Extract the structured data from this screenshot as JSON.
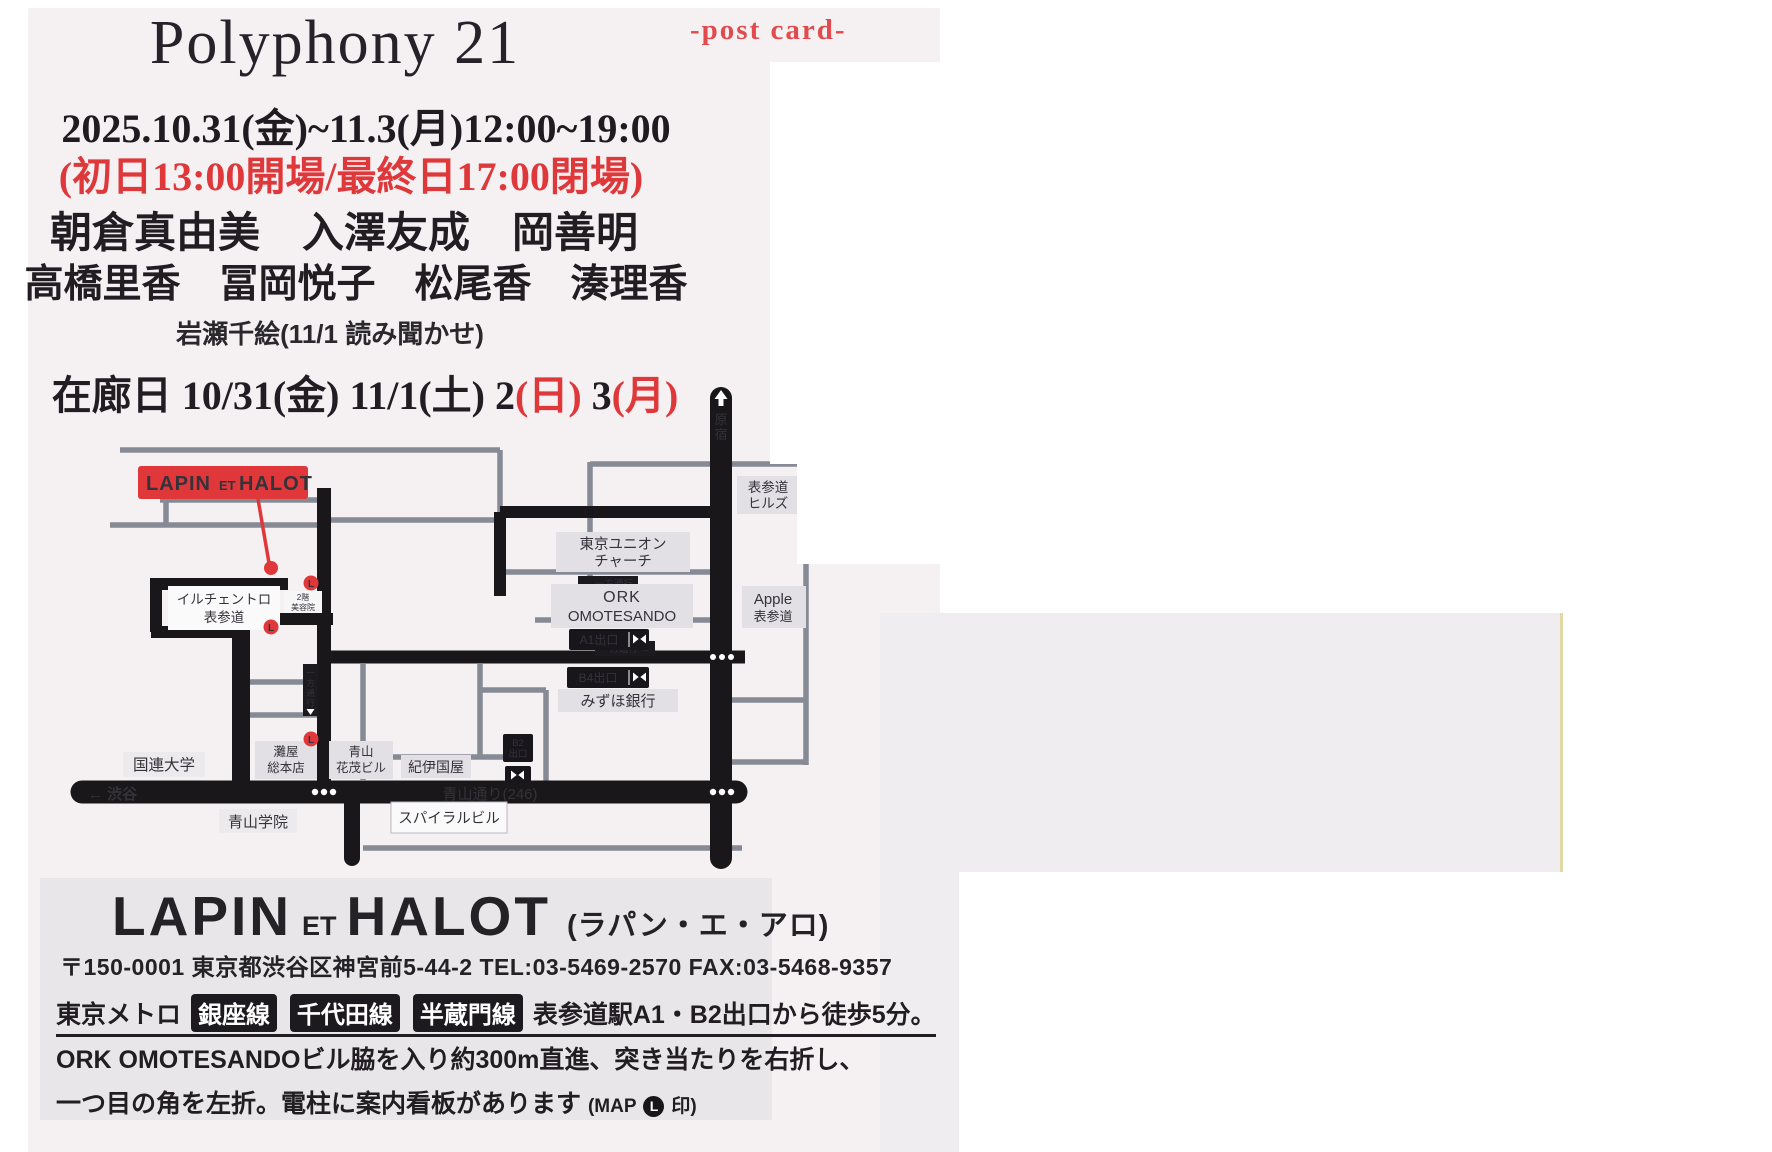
{
  "page": {
    "background": "#ffffff",
    "card_color": "#f5f1f2",
    "accent_red": "#e0393c",
    "ink": "#211d23"
  },
  "header": {
    "title": "Polyphony 21",
    "postcard_label": "-post card-",
    "date_line": "2025.10.31(金)~11.3(月)12:00~19:00",
    "notice_red": "(初日13:00開場/最終日17:00閉場)",
    "artists_line1": "朝倉真由美　入澤友成　岡善明",
    "artists_line2": "高橋里香　冨岡悦子　松尾香　湊理香",
    "reading_line": "岩瀬千絵(11/1 読み聞かせ)",
    "attendance": {
      "part1": "在廊日  10/31(金)  11/1(土)  2",
      "red1": "(日)",
      "part2": "  3",
      "red2": "(月)"
    }
  },
  "map": {
    "venue_badge_parts": [
      "LAPIN",
      "ET",
      "HALOT"
    ],
    "harajuku": [
      "原",
      "宿"
    ],
    "omotesando_hills": [
      "表参道",
      "ヒルズ"
    ],
    "tokyo_union_church": [
      "東京ユニオン",
      "チャーチ"
    ],
    "oneway_left": "← 一方通行",
    "oneway_right": "一方通行 →",
    "oneway_vertical": [
      "一",
      "方",
      "通",
      "行"
    ],
    "il_centro": [
      "イルチェントロ",
      "表参道"
    ],
    "salon_2f": [
      "2階",
      "美容院"
    ],
    "ork": [
      "ORK",
      "OMOTESANDO"
    ],
    "apple": [
      "Apple",
      "表参道"
    ],
    "exit_a1": "A1出口",
    "exit_b4": "B4出口",
    "exit_b2": [
      "B2",
      "出口"
    ],
    "mizuho": "みずほ銀行",
    "kinokuniya": "紀伊国屋",
    "kokuren": "国連大学",
    "nadaya": [
      "灘屋",
      "総本店"
    ],
    "hanashige": [
      "青山",
      "花茂ビル"
    ],
    "aoyama_gakuin": "青山学院",
    "spiral": "スパイラルビル",
    "shibuya": "← 渋谷",
    "aoyama_dori": "青山通り(246)",
    "l_mark": "L"
  },
  "info": {
    "name_lapin": "LAPIN",
    "name_et": "ET",
    "name_halot": "HALOT",
    "name_kana": "(ラパン・エ・アロ)",
    "address": "〒150-0001 東京都渋谷区神宮前5-44-2  TEL:03-5469-2570  FAX:03-5468-9357",
    "line1_prefix": "東京メトロ",
    "line_badges": [
      "銀座線",
      "千代田線",
      "半蔵門線"
    ],
    "line1_suffix": " 表参道駅A1・B2出口から徒歩5分。",
    "line2": "ORK OMOTESANDOビル脇を入り約300m直進、突き当たりを右折し、",
    "line3_main": "一つ目の角を左折。電柱に案内看板があります ",
    "line3_map_prefix": "(MAP",
    "line3_l": "L",
    "line3_map_suffix": "印)"
  }
}
